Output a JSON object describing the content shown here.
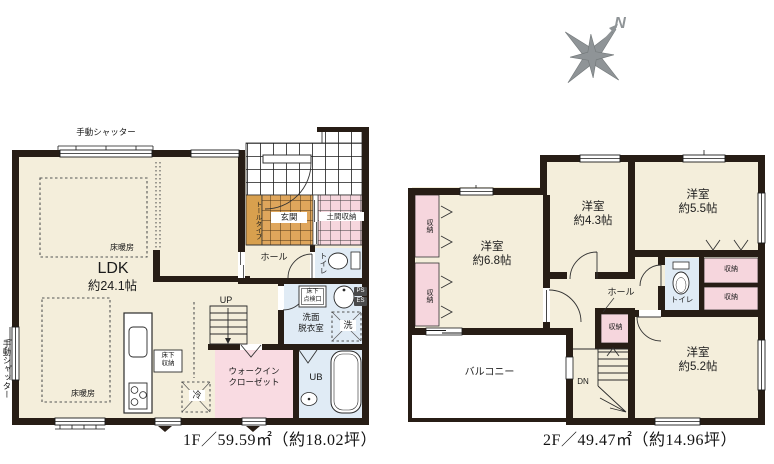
{
  "compass": {
    "north": "N"
  },
  "colors": {
    "wall": "#271d15",
    "floor_cream": "#f4eedb",
    "closet_pink": "#f6d6dd",
    "wet_area_blue": "#e0ebf5",
    "entrance_tile_orange": "#dfa65c",
    "compass_gray": "#8f9497"
  },
  "floor1": {
    "caption": "1F／59.59㎡（約18.02坪）",
    "labels": {
      "shutter_top": "手動シャッター",
      "shutter_left": "手動シャッター",
      "ldk_name": "LDK",
      "ldk_size": "約24.1帖",
      "floor_heating": "床暖房",
      "entrance": "玄関",
      "tall_cabinet": "トールタイプ",
      "doma_storage": "土間収納",
      "hall": "ホール",
      "toilet": "トイレ",
      "inspection_hatch": "床下\n点検口",
      "washroom": "洗面\n脱衣室",
      "laundry": "洗",
      "ps": "PS",
      "es": "ES",
      "unit_bath": "UB",
      "wic": "ウォークイン\nクローゼット",
      "fridge": "冷",
      "underfloor_storage": "床下\n収納",
      "stairs_up": "UP"
    }
  },
  "floor2": {
    "caption": "2F／49.47㎡（約14.96坪）",
    "labels": {
      "room_6_8": "洋室\n約6.8帖",
      "room_4_3": "洋室\n約4.3帖",
      "room_5_5": "洋室\n約5.5帖",
      "room_5_2": "洋室\n約5.2帖",
      "hall": "ホール",
      "toilet": "トイレ",
      "storage": "収納",
      "balcony": "バルコニー",
      "stairs_down": "DN"
    }
  }
}
